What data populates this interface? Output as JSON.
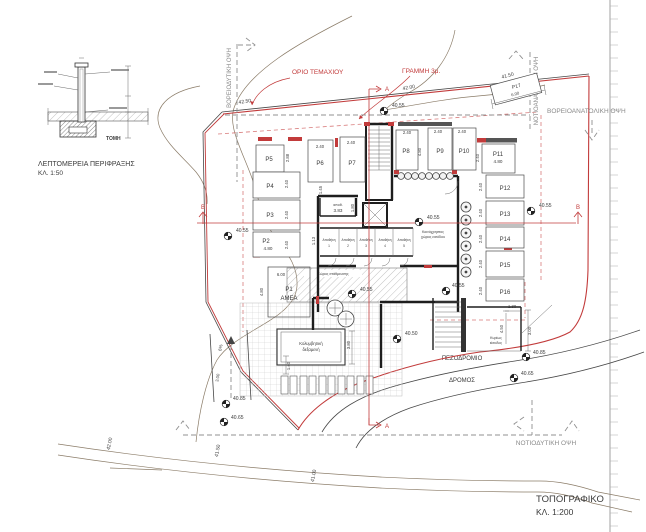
{
  "sheet": {
    "title": "ΤΟΠΟΓΡΑΦΙΚΟ",
    "scale": "ΚΛ. 1:200"
  },
  "detail": {
    "caption": "ΛΕΠΤΟΜΕΡΕΙΑ ΠΕΡΙΦΡΑΞΗΣ",
    "scale": "ΚΛ. 1:50",
    "section": "ΤΟΜΗ"
  },
  "boundary": {
    "plot_label": "ΟΡΙΟ ΤΕΜΑΧΙΟΥ",
    "setback_label": "ΓΡΑΜΜΗ 3μ."
  },
  "views": {
    "nw": "ΒΟΡΕΙΟΔΥΤΙΚΗ ΟΨΗ",
    "se": "ΝΟΤΙΟΑΝΑΤΟΛΙΚΗ ΟΨΗ",
    "ne": "ΒΟΡΕΙΟΑΝΑΤΟΛΙΚΗ ΟΨΗ",
    "sw": "ΝΟΤΙΟΔΥΤΙΚΗ ΟΨΗ"
  },
  "streets": {
    "sidewalk": "ΠΕΖΟΔΡΟΜΙΟ",
    "road": "ΔΡΟΜΟΣ"
  },
  "sections": {
    "a": "A",
    "b": "B"
  },
  "contours": [
    "42.50",
    "42.00",
    "41.50",
    "42.00",
    "41.50",
    "41.00"
  ],
  "spot_elevations": [
    "40.55",
    "40.55",
    "40.55",
    "40.55",
    "40.50",
    "40.55",
    "40.55",
    "40.85",
    "40.65",
    "40.85",
    "40.65"
  ],
  "parking": [
    {
      "id": "P1",
      "sub": "ΑΜΕΑ"
    },
    {
      "id": "P2",
      "sub": "4.80"
    },
    {
      "id": "P3"
    },
    {
      "id": "P4"
    },
    {
      "id": "P5"
    },
    {
      "id": "P6"
    },
    {
      "id": "P7"
    },
    {
      "id": "P8"
    },
    {
      "id": "P9"
    },
    {
      "id": "P10"
    },
    {
      "id": "P11",
      "sub": "4.80"
    },
    {
      "id": "P12"
    },
    {
      "id": "P13"
    },
    {
      "id": "P14"
    },
    {
      "id": "P15"
    },
    {
      "id": "P16"
    },
    {
      "id": "P17",
      "sub": "6.00"
    }
  ],
  "rooms": {
    "storage_small_label": "αποθ.",
    "storage_small_dim": "3.83",
    "storage": "Αποθήκη",
    "storage_units": [
      "1",
      "2",
      "3",
      "4",
      "5"
    ],
    "lobby_l1": "Κοινόχρηστος",
    "lobby_l2": "χώρος εισόδου",
    "pilotis": "Χώρος στάθμευσης",
    "pool_l1": "Κολυμβητική",
    "pool_l2": "δεξαμενή",
    "entry_l1": "Κυρίως",
    "entry_l2": "είσοδος"
  },
  "dims": [
    "2.88",
    "2.40",
    "2.40",
    "2.40",
    "2.40",
    "2.40",
    "2.40",
    "4.80",
    "2.40",
    "2.40",
    "2.40",
    "6.00",
    "4.80",
    "1.13",
    "1.45",
    "1.80",
    "3.80",
    "1.40",
    "2.40",
    "2.40",
    "2.40",
    "2.40",
    "2.40",
    "1.30",
    "4.50",
    "3.00",
    "3.00"
  ],
  "ramp_slope": "6%"
}
